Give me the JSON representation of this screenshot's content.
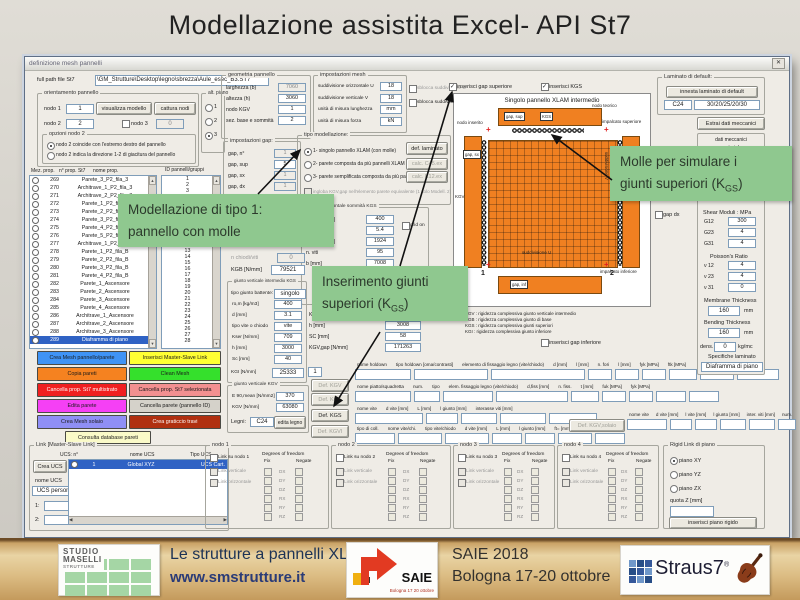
{
  "slide": {
    "title": "Modellazione assistita Excel- API St7"
  },
  "window": {
    "title": "definizione mesh pannelli",
    "close_glyph": "✕"
  },
  "filepath": {
    "label": "full path file St7",
    "value": "\\GM_Strutture\\Desktop\\legno\\sbrezza\\Aule_esec_B3.ST7"
  },
  "orientamento": {
    "title": "orientamento pannello",
    "nodo1_label": "nodo 1",
    "nodo1": "1",
    "visualizza": "visualizza modello",
    "cattura": "cattura nodi",
    "nodo2_label": "nodo 2",
    "nodo2": "2",
    "nodo3_label": "nodo 3",
    "nodo3": "0",
    "opzioni_title": "opzioni nodo 2",
    "radio1": "nodo 2 coincide con l'estremo destro del pannello",
    "radio2": "nodo 2 indica la direzione 1-2 di giacitura del pannello"
  },
  "alt_piano": {
    "title": "alt. piano",
    "o1": "1",
    "o2": "2",
    "o3": "3"
  },
  "prop_list": {
    "h1": "Mez. prop.",
    "h2": "n° prop. St7",
    "h3": "nome prop.",
    "id_header": "ID pannelli/gruppi",
    "rows": [
      {
        "n": "269",
        "name": "Parete_3_P2_fila_3"
      },
      {
        "n": "270",
        "name": "Architrave_1_P2_fila_3"
      },
      {
        "n": "271",
        "name": "Architrave_2_P2_fila_3"
      },
      {
        "n": "272",
        "name": "Parete_1_P2_fila_4"
      },
      {
        "n": "273",
        "name": "Parete_2_P2_fila_4"
      },
      {
        "n": "274",
        "name": "Parete_3_P2_fila_4"
      },
      {
        "n": "275",
        "name": "Parete_4_P2_fila_4"
      },
      {
        "n": "276",
        "name": "Parete_5_P2_fila_4"
      },
      {
        "n": "277",
        "name": "Architrave_1_P2_fila_4"
      },
      {
        "n": "278",
        "name": "Parete_1_P2_fila_B"
      },
      {
        "n": "279",
        "name": "Parete_2_P2_fila_B"
      },
      {
        "n": "280",
        "name": "Parete_3_P2_fila_B"
      },
      {
        "n": "281",
        "name": "Parete_4_P2_fila_B"
      },
      {
        "n": "282",
        "name": "Parete_1_Ascensore"
      },
      {
        "n": "283",
        "name": "Parete_2_Ascensore"
      },
      {
        "n": "284",
        "name": "Parete_3_Ascensore"
      },
      {
        "n": "285",
        "name": "Parete_4_Ascensore"
      },
      {
        "n": "286",
        "name": "Architrave_1_Ascensore"
      },
      {
        "n": "287",
        "name": "Architrave_2_Ascensore"
      },
      {
        "n": "288",
        "name": "Architrave_3_Ascensore"
      },
      {
        "n": "289",
        "name": "Diaframma di piano",
        "c": "sel"
      }
    ],
    "ids": [
      "1",
      "2",
      "3",
      "4",
      "5",
      "6",
      "7",
      "8",
      "9",
      "10",
      "11",
      "12",
      "13",
      "14",
      "15",
      "16",
      "17",
      "18",
      "19",
      "20",
      "21",
      "22",
      "23",
      "24",
      "25",
      "26",
      "27",
      "28"
    ]
  },
  "side_buttons": {
    "crea_mesh": "Crea Mesh pannello/parete",
    "master_slave": "Inserisci Master-Slave Link",
    "copia": "Copia pareti",
    "clean": "Clean Mesh",
    "canc_multi": "Cancella prop. St7 multistrato",
    "canc_sel": "Cancella prop. St7 selezionata",
    "edita": "Edita parete",
    "canc_id": "Cancella parete (pannello ID)",
    "solaio": "Crea Mesh solaio",
    "graticcio": "Crea graticcio travi",
    "consulta": "Consulta database pareti"
  },
  "link_group": {
    "title": "Link [Master-Slave Link]",
    "col_n": "UCS:   n°",
    "col_nome": "nome UCS",
    "col_tipo": "Tipo UCS",
    "crea_ucs": "Crea UCS",
    "nome_ucs": "nome UCS",
    "ucs_value": "UCS person.",
    "r1": "1:",
    "r2": "2:",
    "row_n": "1",
    "row_nome": "Global XYZ",
    "row_tipo": "UCS Cart."
  },
  "geometria": {
    "title": "geometria pannello",
    "rows": [
      {
        "l": "larghezza (b)",
        "v": "7060",
        "c": "dis"
      },
      {
        "l": "altezza (h)",
        "v": "3060"
      },
      {
        "l": "nodo KGV",
        "v": "1"
      },
      {
        "l": "sez. base e sommità",
        "v": "2"
      }
    ]
  },
  "gap": {
    "title": "impostazioni gap:",
    "rows": [
      {
        "l": "gap, n°",
        "v": "1",
        "c": "dis"
      },
      {
        "l": "gap, sup",
        "v": "5"
      },
      {
        "l": "gap, sx",
        "v": "1",
        "c": "dis"
      },
      {
        "l": "gap, dx",
        "v": "1",
        "c": "dis"
      }
    ]
  },
  "mesh": {
    "title": "impostazioni mesh",
    "rows": [
      {
        "l": "suddivisione orizzontale U",
        "v": "18"
      },
      {
        "l": "suddivisione verticale V",
        "v": "18"
      },
      {
        "l": "unità di misura lunghezza",
        "v": "mm"
      },
      {
        "l": "unità di misura forza",
        "v": "kN"
      }
    ],
    "cb1": "sblocca suddivisione U",
    "cb2": "sblocca suddivisione V"
  },
  "tipo_mod": {
    "title": "tipo modellazione:",
    "r1": "1- singolo pannello XLAM (con molle)",
    "r2": "2- parete composta da più pannelli XLAM",
    "r3": "3- parete semplificata composta da più pannelli XLAM",
    "cb": "ingloba KGV,gap nell'elemento parete equivalente (1 solo Modell. 2)",
    "b1": "def. laminato",
    "b2": "calc. C45.ex",
    "b3": "calc. K12.ex"
  },
  "kgs_sup": {
    "title": "giunto orizzontale sommità KGS",
    "cb": "grid on",
    "rows": [
      {
        "l": "ro,m [kg/m3]",
        "v": "400"
      },
      {
        "l": "d [mm]",
        "v": "5.4"
      },
      {
        "l": "Kser [N/mm]",
        "v": "1924"
      },
      {
        "l": "n. viti",
        "v": "95"
      },
      {
        "l": "b [mm]",
        "v": "7008"
      }
    ],
    "rows2": [
      {
        "l": "Kser [N/mm]",
        "v": "2821"
      },
      {
        "l": "h [mm]",
        "v": "3008"
      },
      {
        "l": "SC [mm]",
        "v": "58"
      },
      {
        "l": "KGV,gap  [N/mm]",
        "v": "171263"
      }
    ]
  },
  "mid": {
    "chiodi_label": "n chiodi/viti",
    "chiodi": "0",
    "kgb_label": "KGB [N/mm]",
    "kgb": "79521"
  },
  "kgs_int": {
    "title": "giunto verticale intermedio KGS",
    "tipo_label": "tipo giunto battente:",
    "tipo": "singolo",
    "rows": [
      {
        "l": "ro,m [kg/m3]",
        "v": "400"
      },
      {
        "l": "d [mm]",
        "v": "3.1"
      },
      {
        "l": "tipo vite o chiodo",
        "v": "vite"
      },
      {
        "l": "Kser [N/mm]",
        "v": "709"
      },
      {
        "l": "h [mm]",
        "v": "3000"
      },
      {
        "l": "Sc [mm]",
        "v": "40"
      }
    ],
    "kgi_label": "KGI [N/mm]",
    "kgi": "25333",
    "kgi_n": "1"
  },
  "kgv_grp": {
    "title": "giunto verticale KGV",
    "rows": [
      {
        "l": "E 90,mean [N/mm2]",
        "v": "370"
      },
      {
        "l": "KGV [N/mm]",
        "v": "63080"
      }
    ],
    "legni_label": "Legni:",
    "legno": "C24",
    "edita": "edita legno"
  },
  "def_buttons": {
    "b1": "Def. KGV",
    "b2": "Def. KGS",
    "b3": "Def. KGS",
    "b4": "Def. KGVI",
    "solaio": "Def. KGV,solaio"
  },
  "fasteners": {
    "row1": [
      "nome holdown",
      "tipo holdown [oma/contrasti]",
      "elemento di fissaggio legno (vite/chiodo)",
      "d [mm]",
      "l [mm]",
      "n. fori",
      "l [mm]",
      "fyk [MPa]",
      "ftk [MPa]"
    ],
    "row2": [
      "nome piatto/squadretta",
      "num.",
      "tipo",
      "elem. fissaggio legno (vite/chiodo)",
      "d,fiss [mm]",
      "n. fiss.",
      "t [mm]",
      "fuk [MPa]",
      "fyk [MPa]"
    ],
    "row3": [
      "nome vite",
      "d vite [mm]",
      "L [mm]",
      "l giunto [mm]",
      "interasse viti [mm]"
    ],
    "row4": [
      "tipo di coll.",
      "nome vite/chi.",
      "tipo vite/chiodo",
      "d vite [mm]",
      "L [mm]",
      "l giunto [mm]",
      "ft= [mm]"
    ],
    "row5": [
      "nome vite",
      "d vite [mm]",
      "l vite [mm]",
      "l giunto [mm]",
      "inter. viti [mm]",
      "num."
    ]
  },
  "diagram": {
    "cb_gap": "inserisci gap superiore",
    "cb_kgs": "inserisci KGS",
    "title": "Singolo pannello XLAM intermedio",
    "nodo_teorico": "nodo teorico",
    "impalcato_sup": "impalcato superiore",
    "nodo_inserito": "nodo inserito",
    "gap_sup": "gap, sup",
    "kgs": "KGS",
    "gap_sx": "gap, sx",
    "gap_dx": "gap, dx",
    "kgv": "KGV",
    "kgs_r": "KGS",
    "sud_u": "suddivisione U",
    "sud_v": "suddivisione V",
    "impalcato_inf": "impalcato inferiore",
    "gap_inf": "gap, inf",
    "n1": "1",
    "n2": "2",
    "legend": [
      "KGV : rigidezza complessiva giunto verticale intermedio",
      "KGB : rigidezza complessiva giunto di base",
      "KGS : rigidezza complessiva giunti superiori",
      "KGI : rigidezza complessiva giunto inferiore"
    ],
    "cb_inf": "inserisci gap inferiore"
  },
  "laminato": {
    "title": "Laminato di default:",
    "btn": "innesta laminato di default",
    "f1": "C24",
    "f2": "30/20/25/20/30",
    "estrai": "Estrai dati meccanici",
    "dm1": "dati meccanici",
    "dm2": "material:",
    "dm3": "Orthotropic",
    "gap_dx_cb": "gap dx",
    "shear": "Shear Moduli : MPa",
    "g": [
      {
        "l": "G12",
        "v": "300"
      },
      {
        "l": "G23",
        "v": "4"
      },
      {
        "l": "G31",
        "v": "4"
      }
    ],
    "poisson": "Poisson's Ratio",
    "nu": [
      {
        "l": "ν 12",
        "v": "4"
      },
      {
        "l": "ν 23",
        "v": "4"
      },
      {
        "l": "ν 31",
        "v": "0"
      }
    ],
    "mem": "Membrane Thickness",
    "mem_v": "160",
    "mem_u": "mm",
    "bend": "Bending Thickness",
    "bend_v": "160",
    "bend_u": "mm",
    "dens_l": "dens.",
    "dens_v": "0",
    "dens_u": "kg/mc",
    "spec": "Specifiche laminato",
    "spec_v": "Diaframma di piano"
  },
  "nodes": {
    "n1": "nodo 1",
    "l1": "Link su nodo 1",
    "n2": "nodo 2",
    "l2": "Link su nodo 2",
    "n3": "nodo 3",
    "l3": "Link su nodo 3",
    "n4": "nodo 4",
    "l4": "Link su nodo 4",
    "vert": "Link verticale",
    "oriz": "Link orizzontale",
    "dof": "Degrees of freedom",
    "fix": "Fix",
    "neg": "Negate",
    "rows": [
      "DX",
      "DY",
      "DZ",
      "RX",
      "RY",
      "RZ"
    ]
  },
  "rigid": {
    "title": "Rigid Link di piano",
    "r1": "piano XY",
    "r2": "piano YZ",
    "r3": "piano ZX",
    "quota": "quota    Z [mm]",
    "btn": "inserisci piano rigido"
  },
  "callouts": {
    "c1a": "Modellazione di tipo 1:",
    "c1b": "pannello con molle",
    "c2a": "Inserimento giunti",
    "c2b_pre": "superiori (K",
    "c2b_sub": "GS",
    "c2b_post": ")",
    "c3a": "Molle per simulare i",
    "c3b_pre": "giunti superiori (K",
    "c3b_sub": "GS",
    "c3b_post": ")"
  },
  "footer": {
    "studio_l1": "STUDIO",
    "studio_l2": "MASELLI",
    "studio_l3": "STRUTTURE",
    "t1": "Le strutture a pannelli XLAM",
    "t2": "www.smstrutture.it",
    "saie": "SAIE",
    "saie_sub": "Bologna 17 20 ottobre",
    "t3": "SAIE 2018",
    "t4": "Bologna 17-20 ottobre",
    "straus": "Straus7",
    "reg": "®"
  },
  "colors": {
    "callout_bg": "#8fc88f",
    "panel_orange": "#f08021",
    "selection_blue": "#2f62c4",
    "footer_wood": "#d9b87f"
  }
}
